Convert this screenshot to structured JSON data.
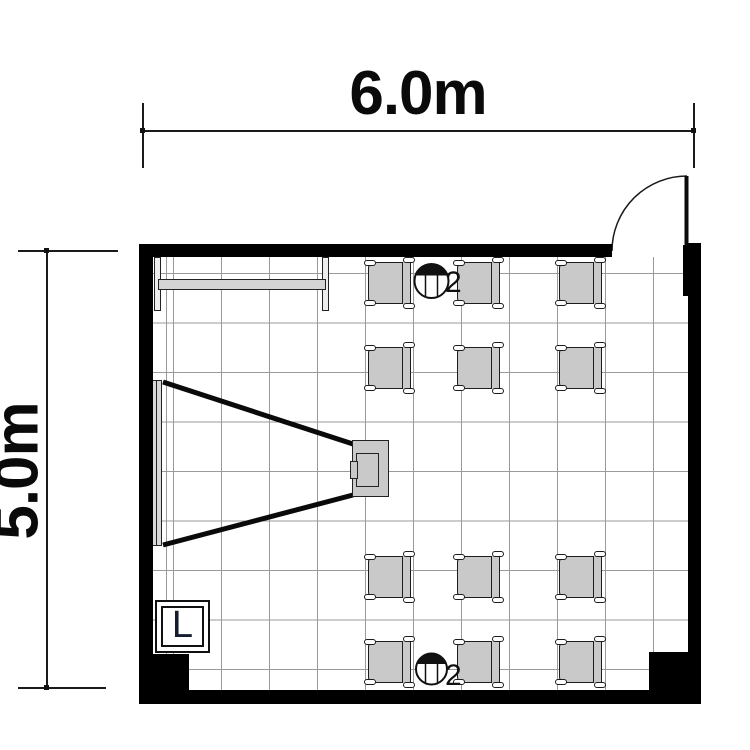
{
  "page": {
    "background": "#ffffff"
  },
  "floor_plan": {
    "type": "classroom-floor-plan",
    "room": {
      "width_label": "6.0m",
      "height_label": "5.0m",
      "wall_color": "#000000"
    },
    "fixtures": {
      "light_symbol_label": "L",
      "outlets": [
        {
          "id": "outlet-top",
          "count_label": "2",
          "position": "top-center"
        },
        {
          "id": "outlet-bottom",
          "count_label": "2",
          "position": "bottom-center"
        }
      ],
      "door": {
        "position": "top-right",
        "swing": "quarter-arc"
      },
      "screen": {
        "position": "left-wall"
      },
      "projector": {
        "position": "center-left"
      },
      "shelf": {
        "position": "top-left"
      }
    },
    "furniture": {
      "chair_rows": 4,
      "chair_columns": 3,
      "chair_total": 12,
      "chair_color": "#c9c9c9",
      "columns_x": [
        366,
        455,
        557
      ],
      "rows_y": [
        259,
        344,
        553,
        638
      ]
    },
    "grid": {
      "tile_color": "#9a9a9a"
    }
  }
}
